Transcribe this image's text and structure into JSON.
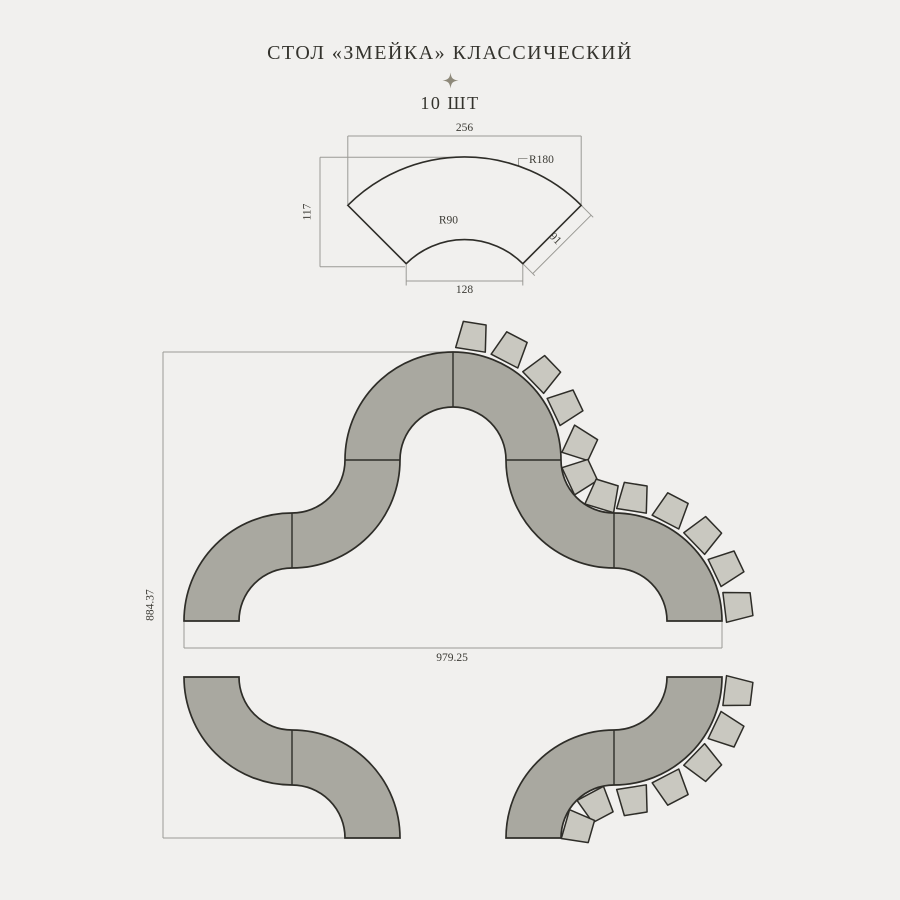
{
  "header": {
    "title": "СТОЛ «ЗМЕЙКА» КЛАССИЧЕСКИЙ",
    "quantity": "10 ШТ"
  },
  "colors": {
    "background": "#f1f0ee",
    "table_fill": "#a9a8a0",
    "chair_fill": "#c9c8c0",
    "outline": "#2e2d28",
    "dim_line": "#9b9a95",
    "dim_text": "#3b3a34",
    "accent_star": "#8e897a"
  },
  "dimensions": {
    "part": {
      "outer_width": "256",
      "left_height": "117",
      "outer_radius": "R180",
      "inner_radius": "R90",
      "side_edge": "91",
      "inner_width": "128"
    },
    "assembly": {
      "total_height": "884.37",
      "top_width": "979.25"
    }
  },
  "geometry": {
    "chairs": {
      "shape": {
        "front_w": 30,
        "back_w": 23,
        "depth": 27
      },
      "groups": [
        {
          "name": "hump-right-arc",
          "cx": 453,
          "cy": 460,
          "radius": 125,
          "angles": [
            -81,
            -62.5,
            -44,
            -25.5
          ],
          "mode": "convex"
        },
        {
          "name": "upper-pocket",
          "cx": 614,
          "cy": 460,
          "radius": 37,
          "angles": [
            205,
            155,
            107
          ],
          "mode": "pocket"
        },
        {
          "name": "right-descent-arc",
          "cx": 614,
          "cy": 621,
          "radius": 125,
          "angles": [
            -81,
            -62.5,
            -44,
            -25.5,
            -7
          ],
          "mode": "convex"
        },
        {
          "name": "lower-right-arc",
          "cx": 614,
          "cy": 677,
          "radius": 125,
          "angles": [
            7,
            25.5,
            44,
            62.5,
            81
          ],
          "mode": "convex"
        },
        {
          "name": "lower-pocket",
          "cx": 614,
          "cy": 838,
          "radius": 37,
          "angles": [
            242,
            196
          ],
          "mode": "pocket"
        }
      ]
    }
  }
}
